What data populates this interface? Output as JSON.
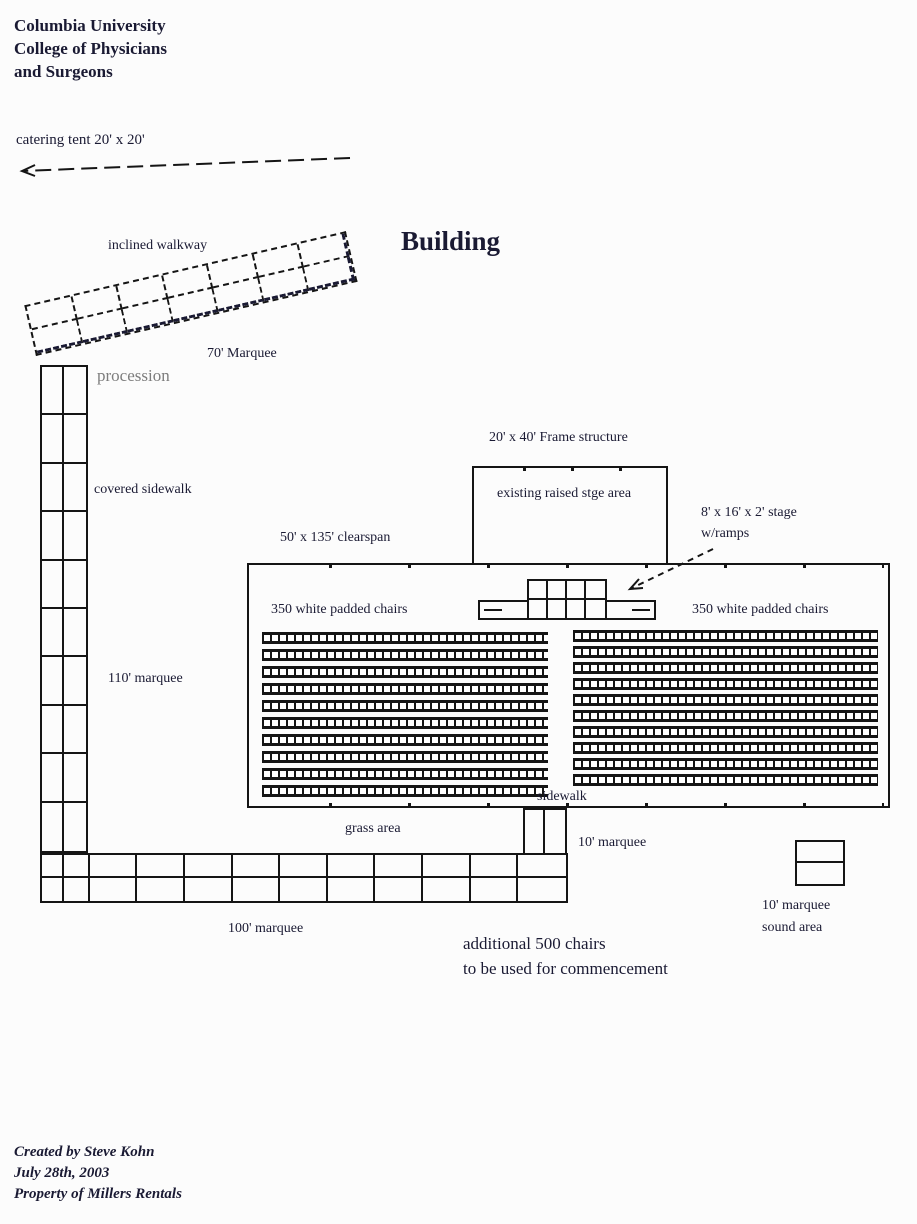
{
  "colors": {
    "line": "#151515",
    "text": "#1a1a33",
    "muted_text": "#7d7d7d",
    "background": "#fcfcfc"
  },
  "header": {
    "line1": "Columbia University",
    "line2": "College of Physicians",
    "line3": "and Surgeons"
  },
  "annotations": {
    "catering_tent": "catering tent 20' x 20'",
    "inclined_walkway": "inclined walkway",
    "building": "Building",
    "marquee_70": "70' Marquee",
    "procession": "procession",
    "covered_sidewalk": "covered sidewalk",
    "marquee_110": "110' marquee",
    "frame_structure": "20' x 40' Frame structure",
    "existing_stage": "existing raised stge area",
    "stage_size": "8' x 16' x 2' stage",
    "stage_ramps": "w/ramps",
    "clearspan": "50' x 135' clearspan",
    "chairs_left": "350 white padded chairs",
    "chairs_right": "350 white padded chairs",
    "sidewalk": "sidewalk",
    "grass_area": "grass area",
    "marquee_10": "10' marquee",
    "marquee_100": "100' marquee",
    "additional_chairs_line1": "additional 500 chairs",
    "additional_chairs_line2": "to be used for commencement",
    "sound_marquee": "10' marquee",
    "sound_area": "sound area"
  },
  "structures": {
    "inclined_walkway": {
      "rows": 2,
      "cols": 7
    },
    "covered_sidewalk_column": {
      "rows": 10,
      "cols": 2
    },
    "horizontal_marquee": {
      "rows": 2,
      "cols": 11
    },
    "stage_platform": {
      "rows": 2,
      "cols": 4
    },
    "connector_marquee": {
      "rows": 1,
      "cols": 2
    },
    "sound_box": {
      "rows": 2,
      "cols": 1
    },
    "chair_block_left": {
      "rows": 10
    },
    "chair_block_right": {
      "rows": 10
    }
  },
  "footer": {
    "line1": "Created by Steve Kohn",
    "line2": "July 28th, 2003",
    "line3": "Property of Millers Rentals"
  }
}
